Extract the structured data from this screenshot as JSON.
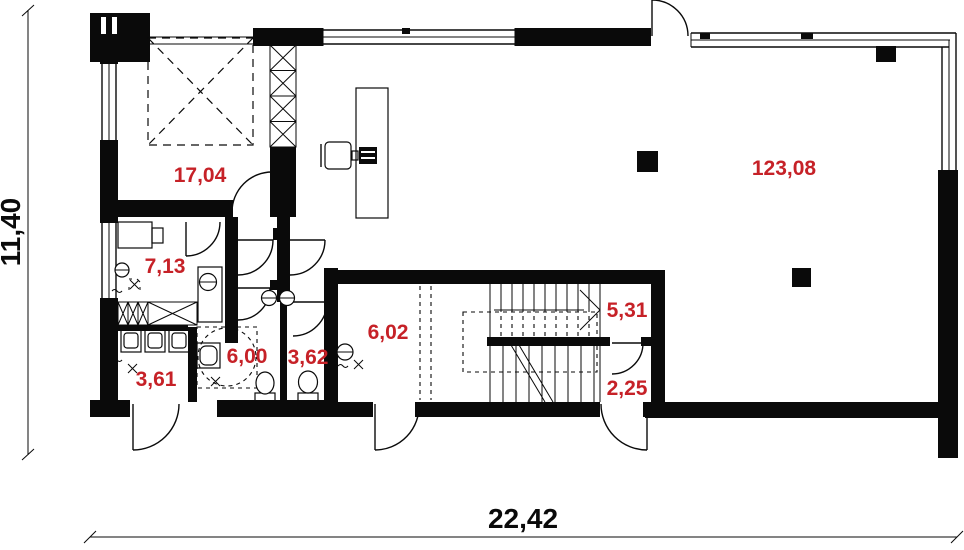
{
  "plan": {
    "title": "floor-plan",
    "dimensions": {
      "total_width": "22,42",
      "total_height": "11,40"
    },
    "rooms": {
      "r1704": {
        "area": "17,04"
      },
      "r713": {
        "area": "7,13"
      },
      "r361": {
        "area": "3,61"
      },
      "r600": {
        "area": "6,00"
      },
      "r362": {
        "area": "3,62"
      },
      "r602": {
        "area": "6,02"
      },
      "r531": {
        "area": "5,31"
      },
      "r225": {
        "area": "2,25"
      },
      "r12308": {
        "area": "123,08"
      }
    },
    "colors": {
      "area_label": "#c62127",
      "wall": "#0a0a0a"
    }
  }
}
